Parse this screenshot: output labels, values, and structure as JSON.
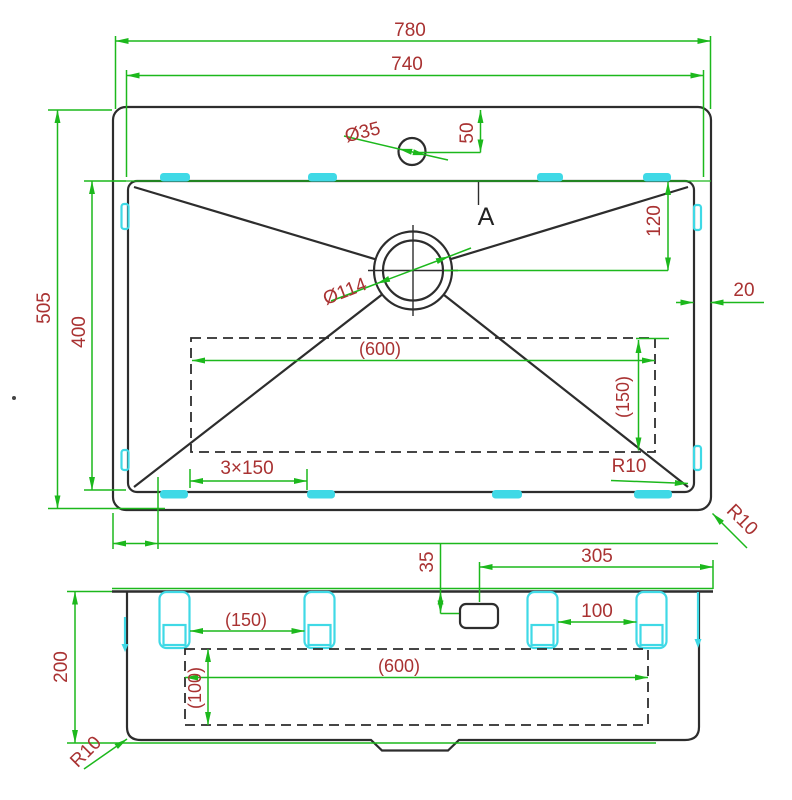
{
  "drawing": {
    "type": "sink-technical-drawing",
    "colors": {
      "dimension_line": "#1cb81c",
      "dimension_text": "#a93232",
      "clip": "#3fd9e6",
      "outline": "#2d2d2d",
      "background": "#ffffff"
    },
    "top_view": {
      "overall_width": "780",
      "bowl_width": "740",
      "faucet_hole_dia": "Ø35",
      "faucet_hole_offset": "50",
      "section_marker": "A",
      "drain_dia": "Ø114",
      "drain_offset": "120",
      "rim_gap": "20",
      "base_width": "(600)",
      "base_depth": "(150)",
      "overall_depth": "505",
      "bowl_depth": "400",
      "clip_spacing": "3×150",
      "inner_corner_radius": "R10",
      "outer_corner_radius": "R10"
    },
    "section_view": {
      "bowl_height": "200",
      "faucet_from_right": "305",
      "faucet_from_back": "35",
      "clip_span_left": "(150)",
      "clip_span_right": "100",
      "base_width": "(600)",
      "base_height": "(100)",
      "corner_radius": "R10"
    }
  }
}
